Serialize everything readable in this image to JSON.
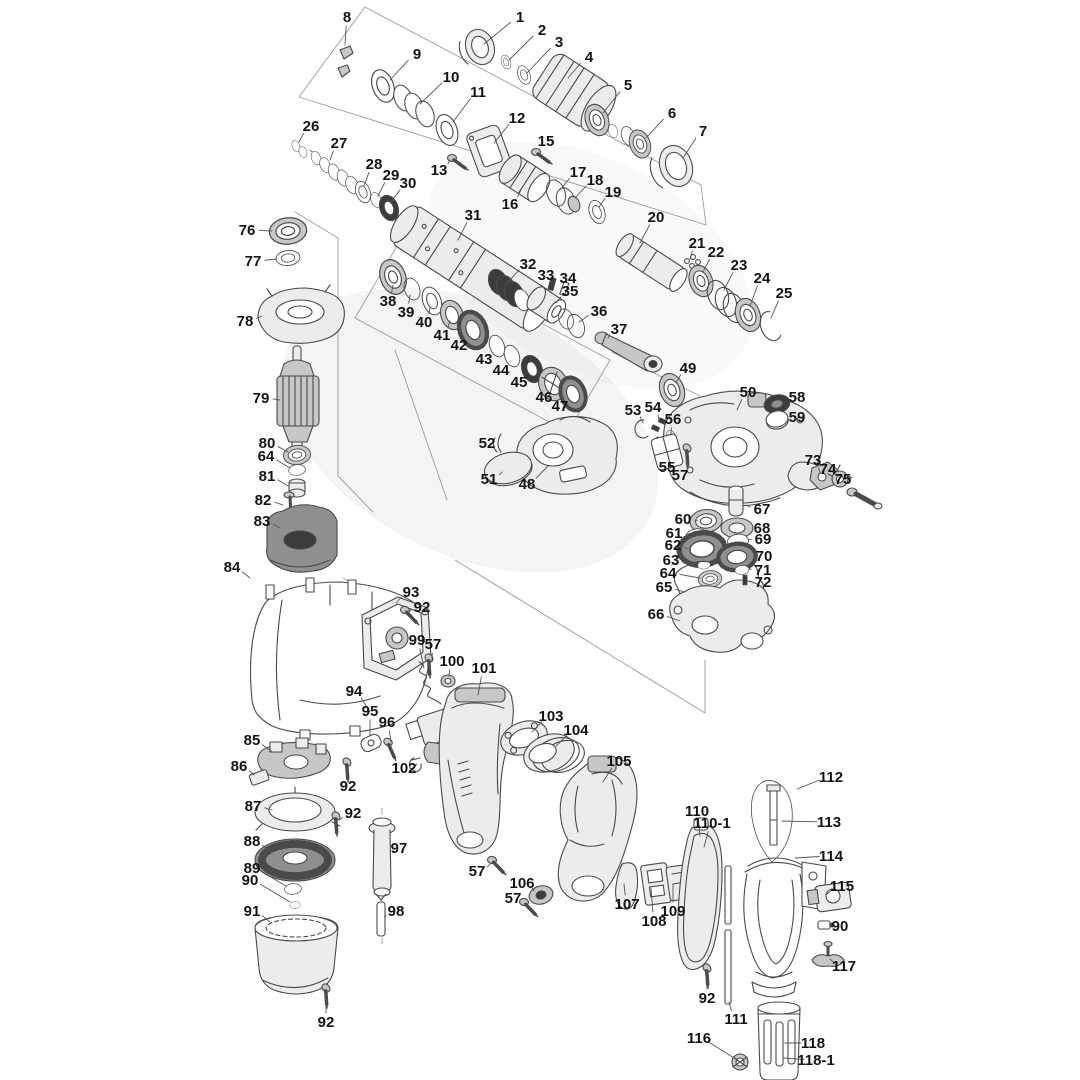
{
  "diagram": {
    "background": "#ffffff",
    "line_color": "#4a4a4a",
    "label_color": "#141414",
    "leader_color": "#555555",
    "parts": [
      {
        "label": "1",
        "x": 520,
        "y": 17,
        "tx": 484,
        "ty": 44
      },
      {
        "label": "2",
        "x": 542,
        "y": 30,
        "tx": 509,
        "ty": 60
      },
      {
        "label": "3",
        "x": 559,
        "y": 42,
        "tx": 527,
        "ty": 73
      },
      {
        "label": "4",
        "x": 589,
        "y": 57,
        "tx": 568,
        "ty": 78
      },
      {
        "label": "5",
        "x": 628,
        "y": 85,
        "tx": 603,
        "ty": 113
      },
      {
        "label": "6",
        "x": 672,
        "y": 113,
        "tx": 646,
        "ty": 138
      },
      {
        "label": "7",
        "x": 703,
        "y": 131,
        "tx": 683,
        "ty": 158
      },
      {
        "label": "8",
        "x": 347,
        "y": 17,
        "tx": 345,
        "ty": 45
      },
      {
        "label": "9",
        "x": 417,
        "y": 54,
        "tx": 390,
        "ty": 80
      },
      {
        "label": "10",
        "x": 451,
        "y": 77,
        "tx": 420,
        "ty": 104
      },
      {
        "label": "11",
        "x": 478,
        "y": 92,
        "tx": 453,
        "ty": 122
      },
      {
        "label": "12",
        "x": 517,
        "y": 118,
        "tx": 494,
        "ty": 143
      },
      {
        "label": "13",
        "x": 439,
        "y": 170,
        "tx": 450,
        "ty": 160
      },
      {
        "label": "15",
        "x": 546,
        "y": 141,
        "tx": 539,
        "ty": 151
      },
      {
        "label": "16",
        "x": 510,
        "y": 204,
        "tx": 521,
        "ty": 190
      },
      {
        "label": "17",
        "x": 578,
        "y": 172,
        "tx": 560,
        "ty": 190
      },
      {
        "label": "18",
        "x": 595,
        "y": 180,
        "tx": 575,
        "ty": 198
      },
      {
        "label": "19",
        "x": 613,
        "y": 192,
        "tx": 599,
        "ty": 207
      },
      {
        "label": "20",
        "x": 656,
        "y": 217,
        "tx": 640,
        "ty": 243
      },
      {
        "label": "21",
        "x": 697,
        "y": 243,
        "tx": 690,
        "ty": 259
      },
      {
        "label": "22",
        "x": 716,
        "y": 252,
        "tx": 703,
        "ty": 272
      },
      {
        "label": "23",
        "x": 739,
        "y": 265,
        "tx": 724,
        "ty": 290
      },
      {
        "label": "24",
        "x": 762,
        "y": 278,
        "tx": 750,
        "ty": 306
      },
      {
        "label": "25",
        "x": 784,
        "y": 293,
        "tx": 771,
        "ty": 318
      },
      {
        "label": "26",
        "x": 311,
        "y": 126,
        "tx": 299,
        "ty": 142
      },
      {
        "label": "27",
        "x": 339,
        "y": 143,
        "tx": 330,
        "ty": 160
      },
      {
        "label": "28",
        "x": 374,
        "y": 164,
        "tx": 364,
        "ty": 186
      },
      {
        "label": "29",
        "x": 391,
        "y": 175,
        "tx": 378,
        "ty": 196
      },
      {
        "label": "30",
        "x": 408,
        "y": 183,
        "tx": 391,
        "ty": 202
      },
      {
        "label": "31",
        "x": 473,
        "y": 215,
        "tx": 458,
        "ty": 240
      },
      {
        "label": "32",
        "x": 528,
        "y": 264,
        "tx": 508,
        "ty": 282
      },
      {
        "label": "33",
        "x": 546,
        "y": 275,
        "tx": 552,
        "ty": 281
      },
      {
        "label": "34",
        "x": 568,
        "y": 278,
        "tx": 566,
        "ty": 286
      },
      {
        "label": "35",
        "x": 570,
        "y": 291,
        "tx": 556,
        "ty": 303
      },
      {
        "label": "36",
        "x": 599,
        "y": 311,
        "tx": 579,
        "ty": 322
      },
      {
        "label": "37",
        "x": 619,
        "y": 329,
        "tx": 608,
        "ty": 338
      },
      {
        "label": "38",
        "x": 388,
        "y": 301,
        "tx": 393,
        "ty": 285
      },
      {
        "label": "39",
        "x": 406,
        "y": 312,
        "tx": 410,
        "ty": 295
      },
      {
        "label": "40",
        "x": 424,
        "y": 322,
        "tx": 430,
        "ty": 308
      },
      {
        "label": "41",
        "x": 442,
        "y": 335,
        "tx": 450,
        "ty": 321
      },
      {
        "label": "42",
        "x": 459,
        "y": 345,
        "tx": 468,
        "ty": 336
      },
      {
        "label": "43",
        "x": 484,
        "y": 359,
        "tx": 494,
        "ty": 351
      },
      {
        "label": "44",
        "x": 501,
        "y": 370,
        "tx": 509,
        "ty": 361
      },
      {
        "label": "45",
        "x": 519,
        "y": 382,
        "tx": 528,
        "ty": 374
      },
      {
        "label": "46",
        "x": 544,
        "y": 397,
        "tx": 551,
        "ty": 389
      },
      {
        "label": "47",
        "x": 560,
        "y": 406,
        "tx": 568,
        "ty": 399
      },
      {
        "label": "48",
        "x": 527,
        "y": 484,
        "tx": 548,
        "ty": 466
      },
      {
        "label": "49",
        "x": 688,
        "y": 368,
        "tx": 676,
        "ty": 383
      },
      {
        "label": "50",
        "x": 748,
        "y": 392,
        "tx": 737,
        "ty": 410
      },
      {
        "label": "51",
        "x": 489,
        "y": 479,
        "tx": 502,
        "ty": 472
      },
      {
        "label": "52",
        "x": 487,
        "y": 443,
        "tx": 497,
        "ty": 446
      },
      {
        "label": "53",
        "x": 633,
        "y": 410,
        "tx": 643,
        "ty": 423
      },
      {
        "label": "54",
        "x": 653,
        "y": 407,
        "tx": 659,
        "ty": 420
      },
      {
        "label": "55",
        "x": 667,
        "y": 467,
        "tx": 664,
        "ty": 456
      },
      {
        "label": "56",
        "x": 673,
        "y": 419,
        "tx": 671,
        "ty": 434
      },
      {
        "label": "57",
        "x": 680,
        "y": 475,
        "tx": 688,
        "ty": 463
      },
      {
        "label": "58",
        "x": 797,
        "y": 397,
        "tx": 786,
        "ty": 403
      },
      {
        "label": "59",
        "x": 797,
        "y": 417,
        "tx": 785,
        "ty": 417
      },
      {
        "label": "60",
        "x": 683,
        "y": 519,
        "tx": 698,
        "ty": 521
      },
      {
        "label": "61",
        "x": 674,
        "y": 533,
        "tx": 689,
        "ty": 536
      },
      {
        "label": "62",
        "x": 673,
        "y": 545,
        "tx": 687,
        "ty": 549
      },
      {
        "label": "63",
        "x": 671,
        "y": 560,
        "tx": 696,
        "ty": 564
      },
      {
        "label": "64",
        "x": 668,
        "y": 573,
        "tx": 700,
        "ty": 578
      },
      {
        "label": "65",
        "x": 664,
        "y": 587,
        "tx": 684,
        "ty": 592
      },
      {
        "label": "66",
        "x": 656,
        "y": 614,
        "tx": 680,
        "ty": 621
      },
      {
        "label": "67",
        "x": 762,
        "y": 509,
        "tx": 745,
        "ty": 505
      },
      {
        "label": "68",
        "x": 762,
        "y": 528,
        "tx": 750,
        "ty": 528
      },
      {
        "label": "69",
        "x": 763,
        "y": 539,
        "tx": 748,
        "ty": 540
      },
      {
        "label": "70",
        "x": 764,
        "y": 556,
        "tx": 752,
        "ty": 556
      },
      {
        "label": "71",
        "x": 763,
        "y": 570,
        "tx": 749,
        "ty": 569
      },
      {
        "label": "72",
        "x": 763,
        "y": 582,
        "tx": 751,
        "ty": 579
      },
      {
        "label": "73",
        "x": 813,
        "y": 460,
        "tx": 820,
        "ty": 473
      },
      {
        "label": "74",
        "x": 828,
        "y": 469,
        "tx": 837,
        "ty": 477
      },
      {
        "label": "75",
        "x": 843,
        "y": 479,
        "tx": 850,
        "ty": 488
      },
      {
        "label": "76",
        "x": 247,
        "y": 230,
        "tx": 272,
        "ty": 231
      },
      {
        "label": "77",
        "x": 253,
        "y": 261,
        "tx": 277,
        "ty": 259
      },
      {
        "label": "78",
        "x": 245,
        "y": 321,
        "tx": 262,
        "ty": 316
      },
      {
        "label": "79",
        "x": 261,
        "y": 398,
        "tx": 280,
        "ty": 400
      },
      {
        "label": "80",
        "x": 267,
        "y": 443,
        "tx": 288,
        "ty": 452
      },
      {
        "label": "64",
        "x": 266,
        "y": 456,
        "tx": 290,
        "ty": 468
      },
      {
        "label": "81",
        "x": 267,
        "y": 476,
        "tx": 288,
        "ty": 486
      },
      {
        "label": "82",
        "x": 263,
        "y": 500,
        "tx": 283,
        "ty": 505
      },
      {
        "label": "83",
        "x": 262,
        "y": 521,
        "tx": 280,
        "ty": 528
      },
      {
        "label": "84",
        "x": 232,
        "y": 567,
        "tx": 250,
        "ty": 578
      },
      {
        "label": "85",
        "x": 252,
        "y": 740,
        "tx": 272,
        "ty": 752
      },
      {
        "label": "86",
        "x": 239,
        "y": 766,
        "tx": 254,
        "ty": 775
      },
      {
        "label": "87",
        "x": 253,
        "y": 806,
        "tx": 272,
        "ty": 810
      },
      {
        "label": "88",
        "x": 252,
        "y": 841,
        "tx": 272,
        "ty": 852
      },
      {
        "label": "89",
        "x": 252,
        "y": 868,
        "tx": 286,
        "ty": 886
      },
      {
        "label": "90",
        "x": 250,
        "y": 880,
        "tx": 290,
        "ty": 902
      },
      {
        "label": "91",
        "x": 252,
        "y": 911,
        "tx": 270,
        "ty": 922
      },
      {
        "label": "92",
        "x": 422,
        "y": 607,
        "tx": 409,
        "ty": 612
      },
      {
        "label": "92",
        "x": 348,
        "y": 786,
        "tx": 347,
        "ty": 772
      },
      {
        "label": "92",
        "x": 353,
        "y": 813,
        "tx": 340,
        "ty": 820
      },
      {
        "label": "92",
        "x": 707,
        "y": 998,
        "tx": 707,
        "ty": 979
      },
      {
        "label": "92",
        "x": 326,
        "y": 1022,
        "tx": 326,
        "ty": 1000
      },
      {
        "label": "93",
        "x": 411,
        "y": 592,
        "tx": 396,
        "ty": 603
      },
      {
        "label": "94",
        "x": 354,
        "y": 691,
        "tx": 370,
        "ty": 712
      },
      {
        "label": "95",
        "x": 370,
        "y": 711,
        "tx": 370,
        "ty": 735
      },
      {
        "label": "96",
        "x": 387,
        "y": 722,
        "tx": 391,
        "ty": 742
      },
      {
        "label": "97",
        "x": 399,
        "y": 848,
        "tx": 390,
        "ty": 851
      },
      {
        "label": "98",
        "x": 396,
        "y": 911,
        "tx": 385,
        "ty": 918
      },
      {
        "label": "99",
        "x": 417,
        "y": 640,
        "tx": 424,
        "ty": 668
      },
      {
        "label": "57",
        "x": 433,
        "y": 644,
        "tx": 432,
        "ty": 660
      },
      {
        "label": "100",
        "x": 452,
        "y": 661,
        "tx": 449,
        "ty": 676
      },
      {
        "label": "101",
        "x": 484,
        "y": 668,
        "tx": 478,
        "ty": 695
      },
      {
        "label": "102",
        "x": 404,
        "y": 768,
        "tx": 417,
        "ty": 764
      },
      {
        "label": "103",
        "x": 551,
        "y": 716,
        "tx": 532,
        "ty": 732
      },
      {
        "label": "104",
        "x": 576,
        "y": 730,
        "tx": 556,
        "ty": 746
      },
      {
        "label": "105",
        "x": 619,
        "y": 761,
        "tx": 603,
        "ty": 782
      },
      {
        "label": "57",
        "x": 477,
        "y": 871,
        "tx": 490,
        "ty": 864
      },
      {
        "label": "106",
        "x": 522,
        "y": 883,
        "tx": 534,
        "ty": 891
      },
      {
        "label": "57",
        "x": 513,
        "y": 898,
        "tx": 523,
        "ty": 904
      },
      {
        "label": "107",
        "x": 627,
        "y": 904,
        "tx": 624,
        "ty": 884
      },
      {
        "label": "108",
        "x": 654,
        "y": 921,
        "tx": 651,
        "ty": 888
      },
      {
        "label": "109",
        "x": 673,
        "y": 911,
        "tx": 673,
        "ty": 884
      },
      {
        "label": "110",
        "x": 697,
        "y": 811,
        "tx": 700,
        "ty": 836
      },
      {
        "label": "110-1",
        "x": 712,
        "y": 823,
        "tx": 704,
        "ty": 847
      },
      {
        "label": "111",
        "x": 736,
        "y": 1019,
        "tx": 729,
        "ty": 1002
      },
      {
        "label": "112",
        "x": 831,
        "y": 777,
        "tx": 797,
        "ty": 789
      },
      {
        "label": "113",
        "x": 829,
        "y": 822,
        "tx": 782,
        "ty": 821
      },
      {
        "label": "114",
        "x": 831,
        "y": 856,
        "tx": 795,
        "ty": 858
      },
      {
        "label": "115",
        "x": 842,
        "y": 886,
        "tx": 826,
        "ty": 895
      },
      {
        "label": "90",
        "x": 840,
        "y": 926,
        "tx": 830,
        "ty": 925
      },
      {
        "label": "117",
        "x": 844,
        "y": 966,
        "tx": 830,
        "ty": 959
      },
      {
        "label": "116",
        "x": 699,
        "y": 1038,
        "tx": 734,
        "ty": 1058
      },
      {
        "label": "118",
        "x": 813,
        "y": 1043,
        "tx": 785,
        "ty": 1043
      },
      {
        "label": "118-1",
        "x": 816,
        "y": 1060,
        "tx": 783,
        "ty": 1058
      }
    ]
  }
}
